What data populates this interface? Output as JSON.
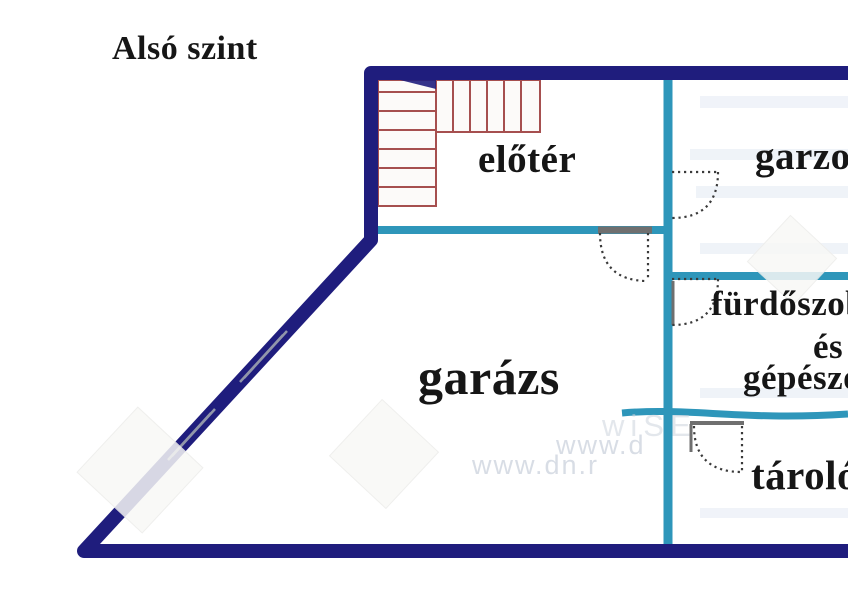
{
  "title": "Alsó szint",
  "rooms": {
    "eloter": "előtér",
    "garzon": "garzon",
    "garazs": "garázs",
    "furdo_line1": "fürdőszoba",
    "furdo_line2": "és",
    "furdo_line3": "gépészet",
    "tarolo": "tároló"
  },
  "watermark": {
    "line1": "www.d",
    "line2": "www.dn.r",
    "badge": "wiSE"
  },
  "colors": {
    "outer_wall": "#1F1D7D",
    "partition_wall": "#2E96BA",
    "stairs": "#A64F4F",
    "door_dots": "#3a3a3a",
    "door_frame": "#6f6f6f",
    "label_text": "#161616"
  }
}
